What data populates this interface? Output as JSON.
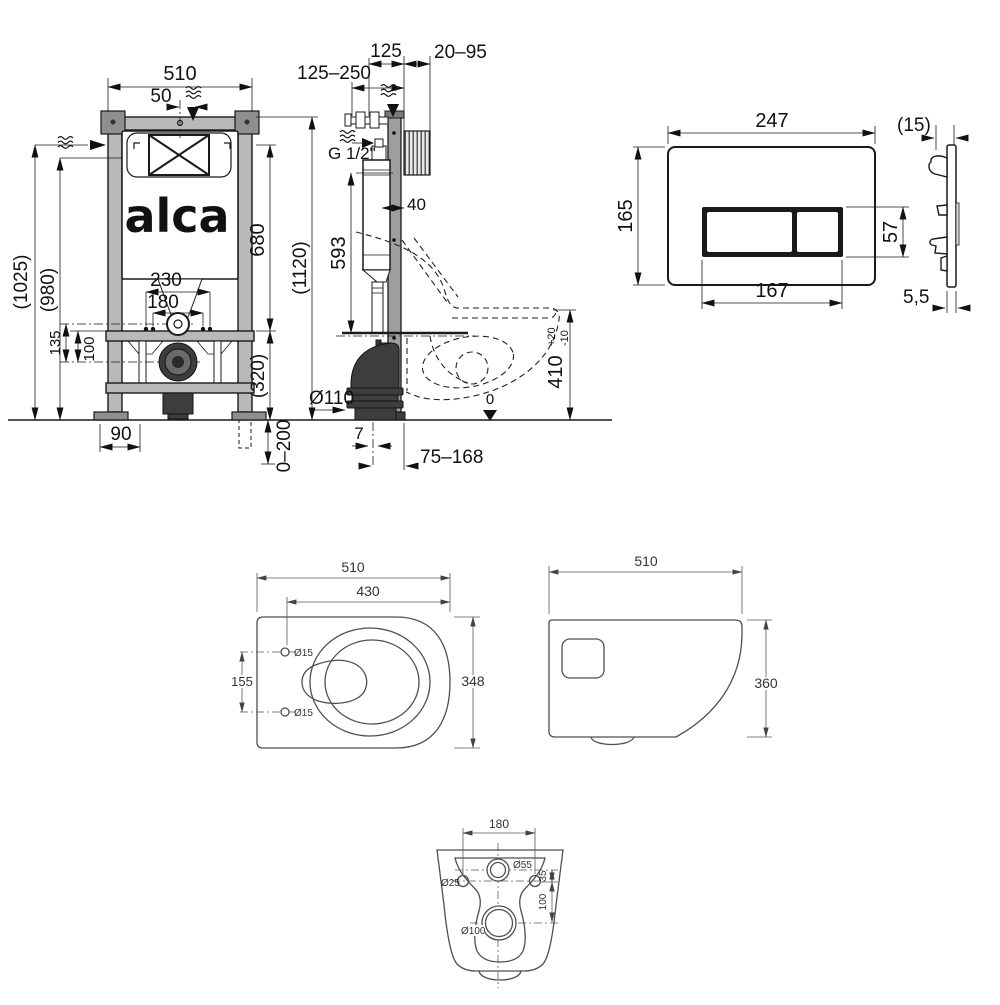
{
  "brand": {
    "logo": "alca"
  },
  "frame_front": {
    "width": "510",
    "supply_offset": "50",
    "height_overall": "(1025)",
    "height_install": "(980)",
    "inlet_to_drain": "135",
    "bolt_to_drain": "100",
    "bolt_span_wide": "230",
    "bolt_span_narrow": "180",
    "cistern_height": "680",
    "frame_height": "(1120)",
    "lower_section": "(320)",
    "foot_width": "90",
    "leg_adjust": "0–200"
  },
  "frame_side": {
    "supply_depth_range": "125–250",
    "frame_depth": "125",
    "wall_clearance": "20–95",
    "water_connection": "G 1/2\"",
    "cistern_depth": "40",
    "flush_pipe_height": "593",
    "drain_diameter": "Ø110",
    "drain_offset": "7",
    "drain_range": "75–168",
    "bowl_height": "410",
    "bowl_height_tol_plus": "+20",
    "bowl_height_tol_minus": "-10",
    "floor_level": "0"
  },
  "flush_plate": {
    "width": "247",
    "height": "165",
    "button_width": "167",
    "button_height": "57",
    "depth": "(15)",
    "thickness": "5,5"
  },
  "wc_top": {
    "length": "510",
    "seat_length": "430",
    "hole_spacing": "155",
    "width": "348",
    "hole_top": "Ø15",
    "hole_bottom": "Ø15"
  },
  "wc_side": {
    "length": "510",
    "height": "360"
  },
  "wc_rear": {
    "bolt_spacing": "180",
    "inlet_diameter": "Ø55",
    "bolt_hole_diameter": "Ø25",
    "inlet_to_bolts": "35",
    "bolts_to_outlet": "100",
    "outlet_diameter": "Ø100"
  }
}
